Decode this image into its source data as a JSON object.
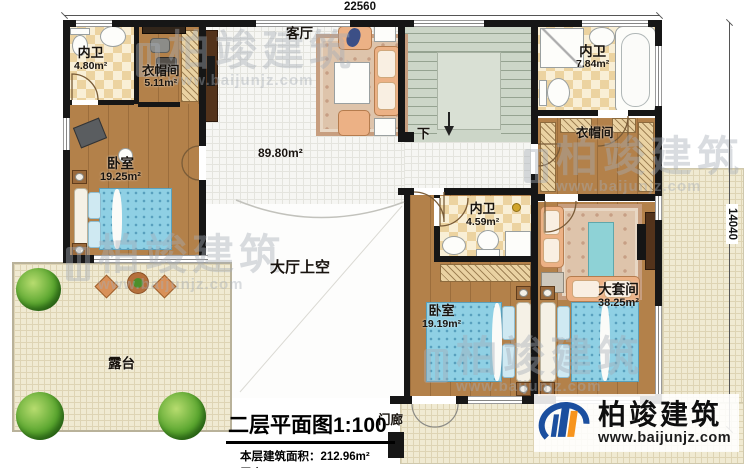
{
  "dimensions": {
    "top": "22560",
    "right": "14040"
  },
  "rooms": {
    "bath_top_left": {
      "name": "内卫",
      "area": "4.80m²"
    },
    "closet_top_left": {
      "name": "衣帽间",
      "area": "5.11m²"
    },
    "living_room": {
      "name": "客厅"
    },
    "bath_top_right": {
      "name": "内卫",
      "area": "7.84m²"
    },
    "closet_right": {
      "name": "衣帽间"
    },
    "bedroom_left": {
      "name": "卧室",
      "area": "19.25m²"
    },
    "hall": {
      "area": "89.80m²"
    },
    "hall_void": {
      "name": "大厅上空"
    },
    "bath_middle": {
      "name": "内卫",
      "area": "4.59m²"
    },
    "bedroom_bottom": {
      "name": "卧室",
      "area": "19.19m²"
    },
    "master_suite": {
      "name": "大套间",
      "area": "38.25m²"
    },
    "terrace": {
      "name": "露台"
    },
    "porch": {
      "name": "门廊"
    }
  },
  "stairs": {
    "down_label": "下"
  },
  "title_block": {
    "title": "二层平面图",
    "scale": "1:100",
    "area_line": "本层建筑面积：212.96m²",
    "height_line": "层高：3.3m"
  },
  "brand": {
    "name": "柏竣建筑",
    "website": "www.baijunjz.com",
    "blue": "#1b4f9f",
    "orange": "#f7941d"
  },
  "watermark": {
    "text": "柏竣建筑",
    "url": "www.baijunjz.com"
  }
}
